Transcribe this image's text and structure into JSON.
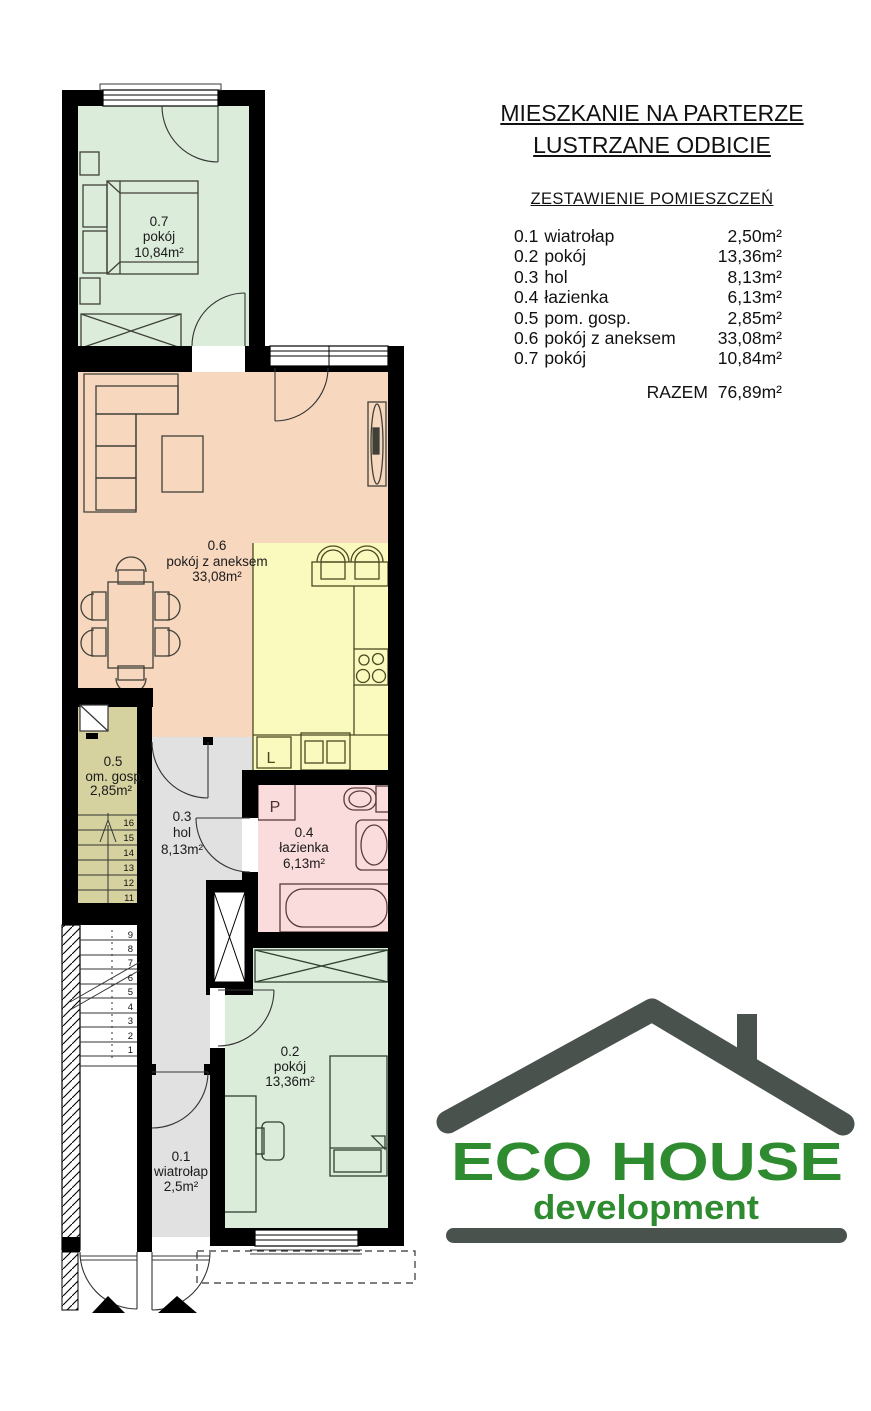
{
  "header": {
    "title_line1": "MIESZKANIE NA PARTERZE",
    "title_line2": "LUSTRZANE ODBICIE",
    "list_title": "ZESTAWIENIE POMIESZCZEŃ",
    "rooms": [
      {
        "no": "0.1",
        "name": "wiatrołap",
        "area": "2,50m²"
      },
      {
        "no": "0.2",
        "name": "pokój",
        "area": "13,36m²"
      },
      {
        "no": "0.3",
        "name": "hol",
        "area": "8,13m²"
      },
      {
        "no": "0.4",
        "name": "łazienka",
        "area": "6,13m²"
      },
      {
        "no": "0.5",
        "name": "pom. gosp.",
        "area": "2,85m²"
      },
      {
        "no": "0.6",
        "name": "pokój z aneksem",
        "area": "33,08m²"
      },
      {
        "no": "0.7",
        "name": "pokój",
        "area": "10,84m²"
      }
    ],
    "total_label": "RAZEM",
    "total_area": "76,89m²"
  },
  "plan": {
    "wall_color": "#000000",
    "rooms": {
      "r07": {
        "no": "0.7",
        "name": "pokój",
        "area": "10,84m²",
        "color": "#dcecdb"
      },
      "r06": {
        "no": "0.6",
        "name": "pokój z aneksem",
        "area": "33,08m²",
        "color": "#f8d7bf"
      },
      "kitchen": {
        "color": "#fafabe"
      },
      "r05": {
        "no": "0.5",
        "name": "om. gosp.",
        "area": "2,85m²",
        "color": "#d6d2a0"
      },
      "r03": {
        "no": "0.3",
        "name": "hol",
        "area": "8,13m²",
        "color": "#e1e1e1"
      },
      "r04": {
        "no": "0.4",
        "name": "łazienka",
        "area": "6,13m²",
        "color": "#fbdcdc"
      },
      "r02": {
        "no": "0.2",
        "name": "pokój",
        "area": "13,36m²",
        "color": "#dcecdb"
      },
      "r01": {
        "no": "0.1",
        "name": "wiatrołap",
        "area": "2,5m²",
        "color": "#e1e1e1"
      }
    },
    "appliance_labels": {
      "fridge": "L",
      "washing_machine": "P"
    },
    "stairs": {
      "upper_steps": [
        "16",
        "15",
        "14",
        "13",
        "12",
        "11"
      ],
      "lower_steps": [
        "9",
        "8",
        "7",
        "6",
        "5",
        "4",
        "3",
        "2",
        "1"
      ]
    }
  },
  "logo": {
    "name": "ECO HOUSE",
    "subtitle": "development",
    "text_color": "#2e8b2f",
    "roof_color": "#4a524d"
  }
}
